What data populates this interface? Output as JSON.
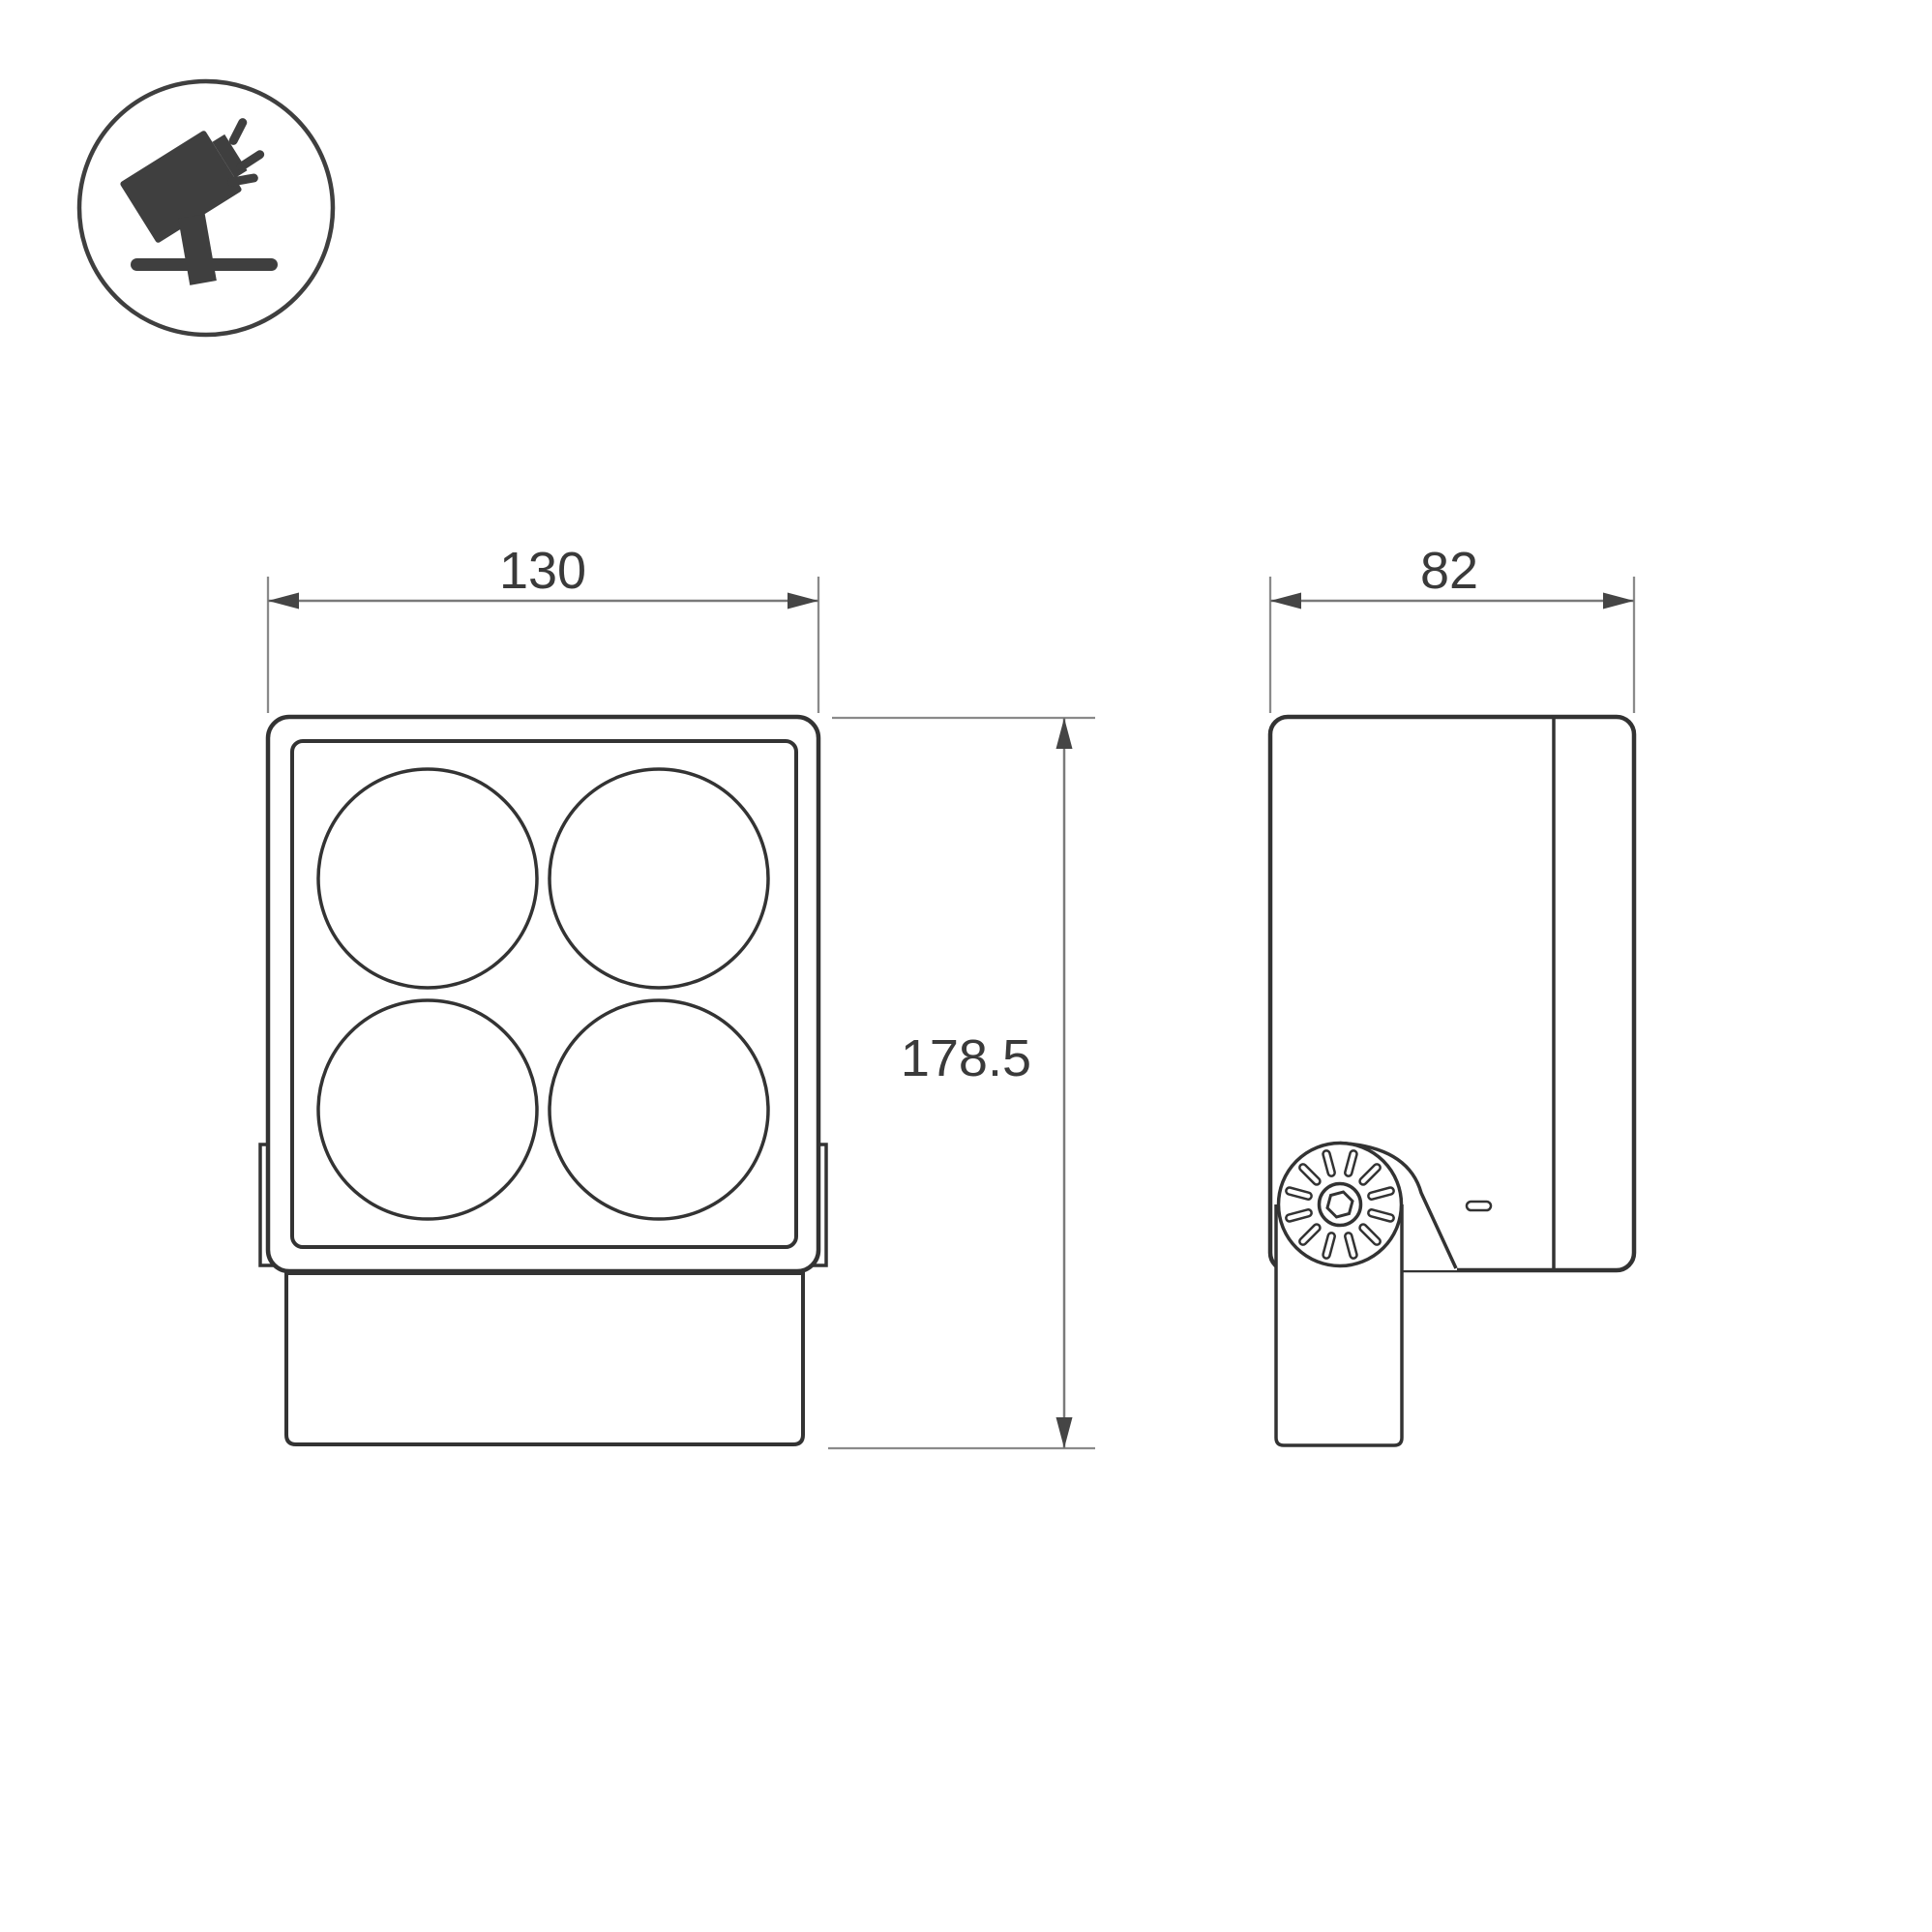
{
  "drawing": {
    "type": "technical-dimension-drawing",
    "subject": "square LED floodlight with yoke mounting bracket",
    "views": {
      "front": {
        "name": "front-view",
        "width_dim": "130",
        "height_dim": "178.5",
        "lens_count": "4"
      },
      "side": {
        "name": "side-view",
        "depth_dim": "82"
      }
    },
    "icon": {
      "name": "tilted-floodlight-on-stand",
      "description": "circled pictogram of a floodlight on a ground stand emitting rays"
    },
    "colors": {
      "outline": "#333333",
      "dimension_line": "#7a7a7a",
      "arrowhead": "#454545",
      "text": "#3a3a3a",
      "background": "#ffffff",
      "icon": "#3f3f3f"
    }
  }
}
